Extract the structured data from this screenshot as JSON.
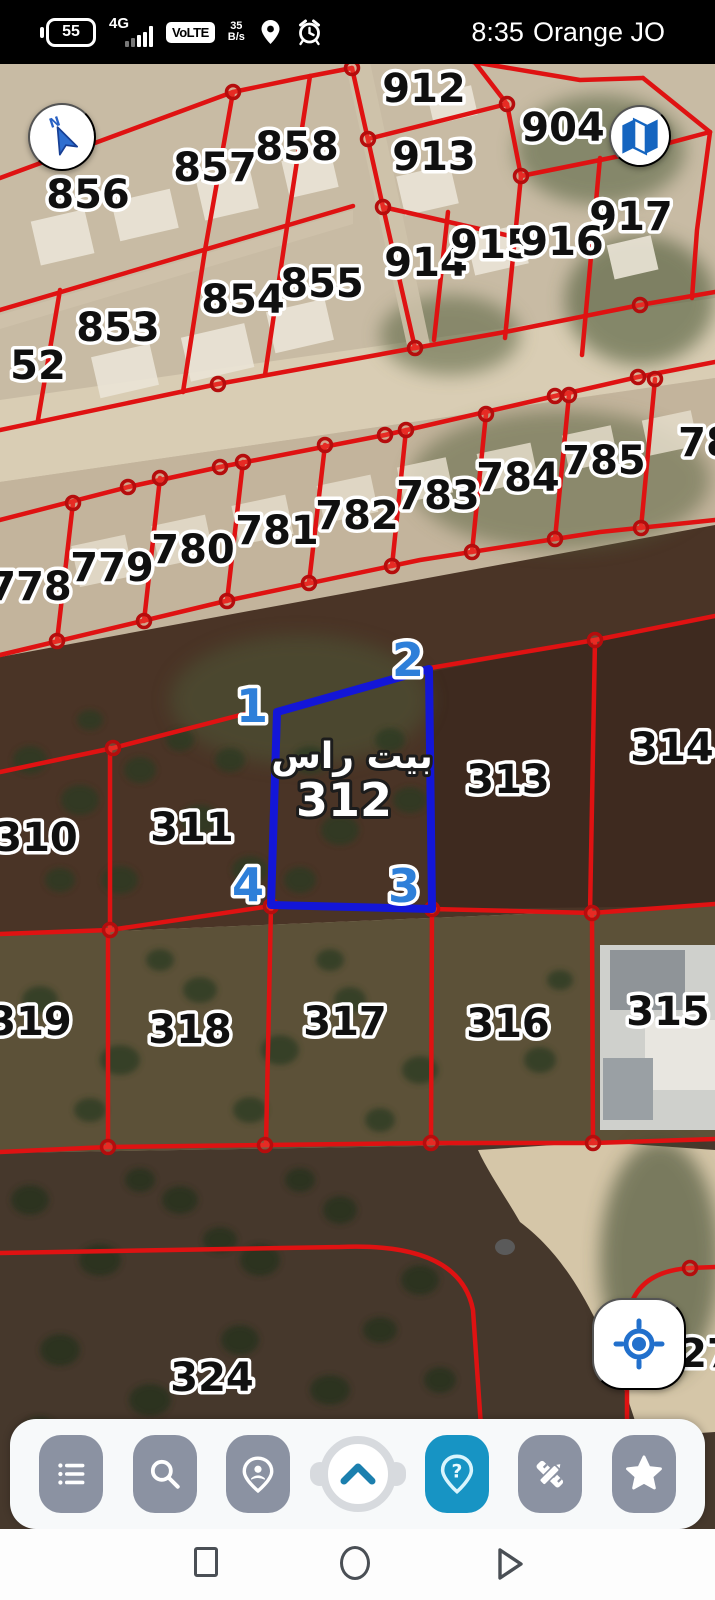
{
  "status_bar": {
    "battery": "55",
    "network": "4G",
    "volte": "VoLTE",
    "rate_value": "35",
    "rate_unit": "B/s",
    "time": "8:35",
    "carrier": "Orange JO"
  },
  "map": {
    "highlight": {
      "name_ar": "بيت راس",
      "number": "312"
    },
    "corners": [
      "1",
      "2",
      "3",
      "4"
    ],
    "parcels": [
      {
        "label": "856"
      },
      {
        "label": "857"
      },
      {
        "label": "858"
      },
      {
        "label": "912"
      },
      {
        "label": "913"
      },
      {
        "label": "904"
      },
      {
        "label": "917"
      },
      {
        "label": "914"
      },
      {
        "label": "915"
      },
      {
        "label": "916"
      },
      {
        "label": "853"
      },
      {
        "label": "854"
      },
      {
        "label": "855"
      },
      {
        "label": "52"
      },
      {
        "label": "778"
      },
      {
        "label": "779"
      },
      {
        "label": "780"
      },
      {
        "label": "781"
      },
      {
        "label": "782"
      },
      {
        "label": "783"
      },
      {
        "label": "784"
      },
      {
        "label": "785"
      },
      {
        "label": "78"
      },
      {
        "label": "310"
      },
      {
        "label": "311"
      },
      {
        "label": "313"
      },
      {
        "label": "314"
      },
      {
        "label": "319"
      },
      {
        "label": "318"
      },
      {
        "label": "317"
      },
      {
        "label": "316"
      },
      {
        "label": "315"
      },
      {
        "label": "324"
      },
      {
        "label": "27"
      }
    ],
    "colors": {
      "boundary_red": "#df1212",
      "highlight_blue": "#1316d8",
      "corner_label_blue": "#2e7fd9",
      "help_teal": "#1794c4",
      "button_gray": "#8b92a2"
    }
  },
  "controls": {
    "compass_letter": "N",
    "icons": [
      "compass-icon",
      "map-layers-icon",
      "my-location-icon"
    ]
  },
  "toolbar": {
    "buttons": [
      {
        "icon": "menu-list-icon"
      },
      {
        "icon": "search-icon"
      },
      {
        "icon": "person-pin-icon"
      },
      {
        "icon": "collapse-chevron-icon"
      },
      {
        "icon": "help-pin-icon",
        "active": true
      },
      {
        "icon": "tools-icon"
      },
      {
        "icon": "favorites-star-icon"
      }
    ],
    "help_glyph": "?"
  },
  "nav_bar": {
    "buttons": [
      "recents",
      "home",
      "back"
    ]
  }
}
